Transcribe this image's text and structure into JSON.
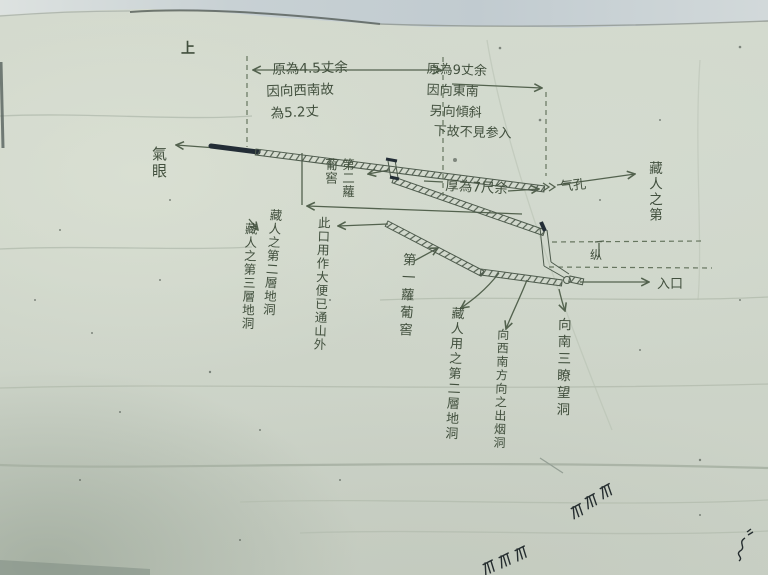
{
  "photo": {
    "kind_note": "hand-drawn tunnel sketch on creased paper"
  },
  "annotations": {
    "orientation_mark": "上",
    "air_eye": "氣眼",
    "upper_measure": {
      "line1": "原為4.5丈余",
      "line2": "因向西南故",
      "line3": "為5.2丈"
    },
    "right_measure": {
      "line1": "原為9丈余",
      "line2": "因向東南",
      "line3": "另向傾斜",
      "line4": "下故不見参入"
    },
    "thickness_note": "厚為7尺余",
    "air_hole": "气孔",
    "hiding_right": "藏人之第",
    "depth_mark": "纵",
    "entrance": "入口",
    "cellar_upper": "第二蘿葡窖",
    "cellar_center": "第一蘿葡窖",
    "second_layer_cave": "藏人之第二層地洞",
    "third_layer_cave": "藏人之第三層地洞",
    "latrine_note": "此口用作大便已通山外",
    "second_layer_cave_lower": "藏人用之第二層地洞",
    "smoke_outlet": "向西南方向之出烟洞",
    "south_lookout": "向南三瞭望洞"
  },
  "colors": {
    "paper": "#cfd6ca",
    "backing_sheet": "#c8d1d4",
    "handwriting_ink": "#42503e",
    "pencil_line": "#53624e",
    "dark_ink_segment": "#232d36",
    "doodle_ink": "#252d2f"
  }
}
